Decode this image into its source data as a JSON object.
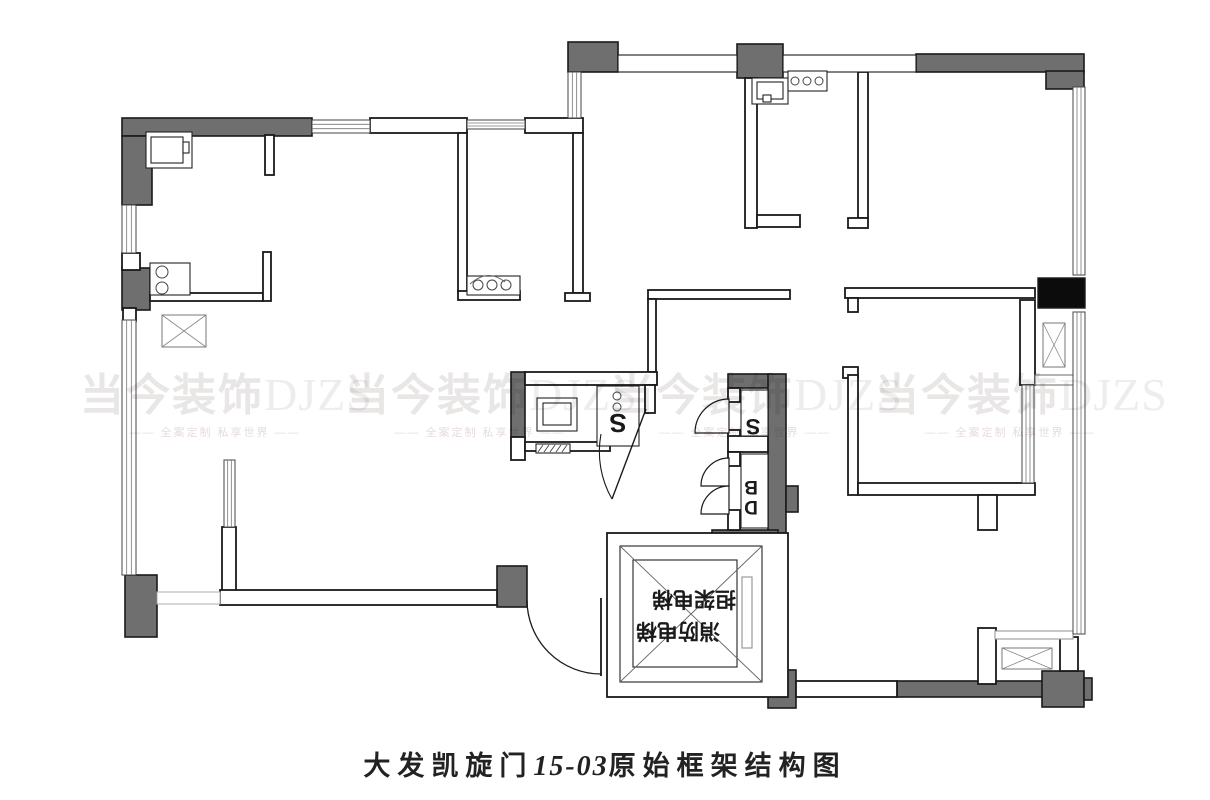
{
  "title": {
    "part1": "大发凯旋门",
    "part2": "15-03",
    "part3": "原始框架结构图"
  },
  "watermark": {
    "brand_cn": "当今装饰",
    "brand_en": "DJZS",
    "tagline": "全案定制 私享世界",
    "dash": "——",
    "positions": [
      {
        "cx": 215,
        "cy": 372
      },
      {
        "cx": 480,
        "cy": 372
      },
      {
        "cx": 745,
        "cy": 372
      },
      {
        "cx": 1010,
        "cy": 372
      }
    ]
  },
  "colors": {
    "line": "#1a1a1a",
    "gray": "#6f6f6f",
    "black": "#0c0c0c",
    "thin": "#333",
    "mid": "#666",
    "light": "#999",
    "open": "#b5b5b5",
    "bg": "#ffffff"
  },
  "elevator": {
    "label_line1": "担架电梯",
    "label_line2": "消防电梯"
  },
  "plan": {
    "grays": [
      [
        122,
        118,
        190,
        18,
        "beam-top-left"
      ],
      [
        122,
        136,
        30,
        69,
        "column-left-leg"
      ],
      [
        122,
        268,
        28,
        42,
        "column-left-mid"
      ],
      [
        125,
        575,
        32,
        62,
        "column-bottom-left"
      ],
      [
        497,
        566,
        30,
        41,
        "column-entry"
      ],
      [
        568,
        42,
        50,
        30,
        "column-top-a"
      ],
      [
        737,
        44,
        46,
        34,
        "column-top-b"
      ],
      [
        916,
        54,
        168,
        18,
        "beam-top-right"
      ],
      [
        1046,
        71,
        38,
        18,
        "beam-top-right-leg"
      ],
      [
        511,
        372,
        14,
        66,
        "wall-bath-left"
      ],
      [
        728,
        374,
        42,
        14,
        "wall-bath-top"
      ],
      [
        768,
        374,
        18,
        168,
        "wall-bath-right"
      ],
      [
        712,
        530,
        66,
        15,
        "beam-bath-bottom"
      ],
      [
        786,
        486,
        12,
        26,
        "tab-bath-right"
      ],
      [
        768,
        670,
        28,
        38,
        "column-bottom-elevator"
      ],
      [
        897,
        681,
        148,
        16,
        "beam-bottom-right"
      ],
      [
        1042,
        671,
        42,
        36,
        "column-bottom-right"
      ],
      [
        1084,
        678,
        8,
        22,
        "tab-bottom-right"
      ]
    ],
    "blacks": [
      [
        1038,
        278,
        47,
        30,
        "column-black-right"
      ]
    ],
    "walls": [
      [
        265,
        135,
        9,
        40
      ],
      [
        150,
        293,
        113,
        8
      ],
      [
        263,
        252,
        8,
        49
      ],
      [
        370,
        118,
        97,
        15
      ],
      [
        458,
        133,
        9,
        160
      ],
      [
        458,
        291,
        62,
        9
      ],
      [
        525,
        118,
        58,
        15
      ],
      [
        573,
        133,
        10,
        160
      ],
      [
        565,
        293,
        25,
        8
      ],
      [
        745,
        78,
        12,
        150
      ],
      [
        757,
        215,
        43,
        12
      ],
      [
        858,
        72,
        10,
        146
      ],
      [
        848,
        218,
        20,
        10
      ],
      [
        648,
        290,
        142,
        9
      ],
      [
        845,
        288,
        190,
        10
      ],
      [
        848,
        298,
        10,
        14
      ],
      [
        648,
        299,
        8,
        73
      ],
      [
        525,
        372,
        132,
        13
      ],
      [
        645,
        385,
        10,
        28
      ],
      [
        511,
        437,
        14,
        23
      ],
      [
        525,
        442,
        85,
        9
      ],
      [
        222,
        527,
        14,
        65
      ],
      [
        220,
        590,
        277,
        15
      ],
      [
        843,
        367,
        15,
        11
      ],
      [
        848,
        375,
        10,
        120
      ],
      [
        858,
        483,
        177,
        12
      ],
      [
        978,
        495,
        19,
        35
      ],
      [
        1020,
        300,
        15,
        85
      ],
      [
        978,
        628,
        18,
        56
      ],
      [
        768,
        545,
        15,
        126
      ],
      [
        796,
        681,
        101,
        16
      ],
      [
        1060,
        637,
        18,
        34
      ],
      [
        122,
        253,
        18,
        17
      ],
      [
        123,
        308,
        13,
        13
      ],
      [
        728,
        388,
        12,
        14
      ],
      [
        728,
        430,
        12,
        8
      ],
      [
        728,
        436,
        40,
        16
      ],
      [
        728,
        452,
        12,
        14
      ],
      [
        728,
        510,
        12,
        20
      ],
      [
        607,
        533,
        181,
        164,
        "elevator-outer-wall"
      ]
    ],
    "dwalls": [
      [
        618,
        55,
        119,
        17,
        "#1a1a1a",
        "window-wall-top-1"
      ],
      [
        783,
        55,
        133,
        17,
        "#1a1a1a",
        "window-wall-top-2"
      ],
      [
        157,
        592,
        63,
        12,
        "#b5b5b5",
        "opening-bottom-left"
      ],
      [
        1035,
        375,
        42,
        10,
        "#777",
        "shaft-ledge-right"
      ],
      [
        995,
        631,
        78,
        8,
        "#999",
        "ledge-bottom-right"
      ]
    ],
    "windows": [
      [
        122,
        205,
        14,
        48,
        "v"
      ],
      [
        122,
        320,
        14,
        255,
        "v"
      ],
      [
        312,
        120,
        58,
        13,
        "h"
      ],
      [
        467,
        120,
        58,
        9,
        "h"
      ],
      [
        568,
        72,
        13,
        46,
        "v"
      ],
      [
        1073,
        87,
        12,
        188,
        "v"
      ],
      [
        1073,
        312,
        12,
        322,
        "v"
      ],
      [
        1022,
        385,
        12,
        98,
        "v"
      ],
      [
        224,
        460,
        11,
        67,
        "v"
      ]
    ],
    "xboxes": [
      [
        162,
        315,
        44,
        32,
        "vent-shaft-left"
      ],
      [
        1043,
        323,
        22,
        44,
        "vent-shaft-right"
      ],
      [
        1002,
        648,
        50,
        21,
        "vent-shaft-bottom"
      ]
    ],
    "thin_rects": [
      [
        146,
        132,
        46,
        36,
        "sink-top-left"
      ],
      [
        151,
        137,
        32,
        26,
        "sink-top-left-inner"
      ],
      [
        183,
        142,
        6,
        11,
        "sink-tab"
      ],
      [
        150,
        263,
        40,
        32,
        "stove-left"
      ],
      [
        467,
        276,
        53,
        19,
        "counter-kitchen"
      ],
      [
        752,
        78,
        36,
        26,
        "basin-top"
      ],
      [
        757,
        82,
        26,
        17,
        "basin-top-inner"
      ],
      [
        763,
        95,
        8,
        7,
        "basin-tap"
      ],
      [
        788,
        71,
        39,
        20,
        "counter-top"
      ],
      [
        537,
        398,
        40,
        33,
        "washbasin-bath"
      ],
      [
        543,
        403,
        28,
        22,
        "washbasin-bath-inner"
      ],
      [
        597,
        386,
        42,
        60,
        "toilet-box"
      ],
      [
        741,
        390,
        27,
        46,
        "wc-upper-room"
      ],
      [
        741,
        454,
        27,
        74,
        "wc-lower-room"
      ],
      [
        536,
        444,
        34,
        9,
        "hatch-strip"
      ],
      [
        620,
        546,
        142,
        136,
        "elevator-inner"
      ],
      [
        633,
        560,
        104,
        107,
        "elevator-car"
      ]
    ],
    "light_rects": [
      [
        742,
        577,
        10,
        71,
        "elevator-door-slot"
      ]
    ],
    "circles": [
      [
        162,
        272,
        6
      ],
      [
        162,
        288,
        6
      ],
      [
        478,
        285,
        5
      ],
      [
        492,
        285,
        5
      ],
      [
        506,
        285,
        5
      ],
      [
        795,
        81,
        4
      ],
      [
        807,
        81,
        4
      ],
      [
        819,
        81,
        4
      ],
      [
        617,
        396,
        4
      ],
      [
        617,
        407,
        4
      ]
    ],
    "lines": [
      [
        620,
        546,
        762,
        682,
        "#666",
        "elevator-diagonal-1"
      ],
      [
        762,
        546,
        620,
        682,
        "#666",
        "elevator-diagonal-2"
      ]
    ],
    "paths": [
      {
        "d": "M 527 600 A 74 74 0 0 0 601 674",
        "fill": "none",
        "s": "#1a1a1a",
        "w": 1.3,
        "n": "entry-door-arc"
      },
      {
        "d": "M 601 598 L 601 676",
        "fill": "none",
        "s": "#1a1a1a",
        "w": 1.8,
        "n": "entry-door-leaf"
      },
      {
        "d": "M 646 409 L 612 499",
        "fill": "none",
        "s": "#1a1a1a",
        "w": 1.4,
        "n": "bath-door-leaf"
      },
      {
        "d": "M 612 499 A 95 95 0 0 1 601 434",
        "fill": "none",
        "s": "#1a1a1a",
        "w": 1.1,
        "n": "bath-door-arc"
      },
      {
        "d": "M 729 433 L 729 399 A 34 34 0 0 0 695 433 Z",
        "fill": "#ffffff",
        "s": "#1a1a1a",
        "w": 1.2,
        "n": "wc1-door-fan"
      },
      {
        "d": "M 729 486 L 729 458 A 28 28 0 0 0 701 486 Z",
        "fill": "#ffffff",
        "s": "#1a1a1a",
        "w": 1.2,
        "n": "wc2-door-fan-a"
      },
      {
        "d": "M 729 514 L 729 486 A 28 28 0 0 0 701 514 Z",
        "fill": "#ffffff",
        "s": "#1a1a1a",
        "w": 1.2,
        "n": "wc2-door-fan-b"
      },
      {
        "d": "M 470 284 Q 488 268 505 282",
        "fill": "none",
        "s": "#666",
        "w": 1,
        "n": "faucet-curve"
      },
      {
        "d": "M538 452 L543 445 M544 452 L549 445 M550 452 L555 445 M556 452 L561 445 M562 452 L567 445",
        "fill": "none",
        "s": "#444",
        "w": 0.9,
        "n": "hatch-ticks"
      }
    ],
    "labels": [
      {
        "t": "S",
        "x": 618,
        "y": 414,
        "size": 26,
        "rot": 180,
        "n": "toilet-glyph-s1"
      },
      {
        "t": "S",
        "x": 753,
        "y": 419,
        "size": 22,
        "rot": 180,
        "n": "toilet-glyph-s2"
      },
      {
        "t": "B",
        "x": 751,
        "y": 481,
        "size": 19,
        "rot": 180,
        "n": "fixture-glyph-b"
      },
      {
        "t": "D",
        "x": 751,
        "y": 501,
        "size": 19,
        "rot": 180,
        "n": "fixture-glyph-d"
      },
      {
        "t": "担架电梯",
        "x": 694,
        "y": 592,
        "size": 21,
        "rot": 180,
        "n": "elevator-label-1"
      },
      {
        "t": "消防电梯",
        "x": 678,
        "y": 624,
        "size": 21,
        "rot": 180,
        "n": "elevator-label-2"
      }
    ]
  }
}
